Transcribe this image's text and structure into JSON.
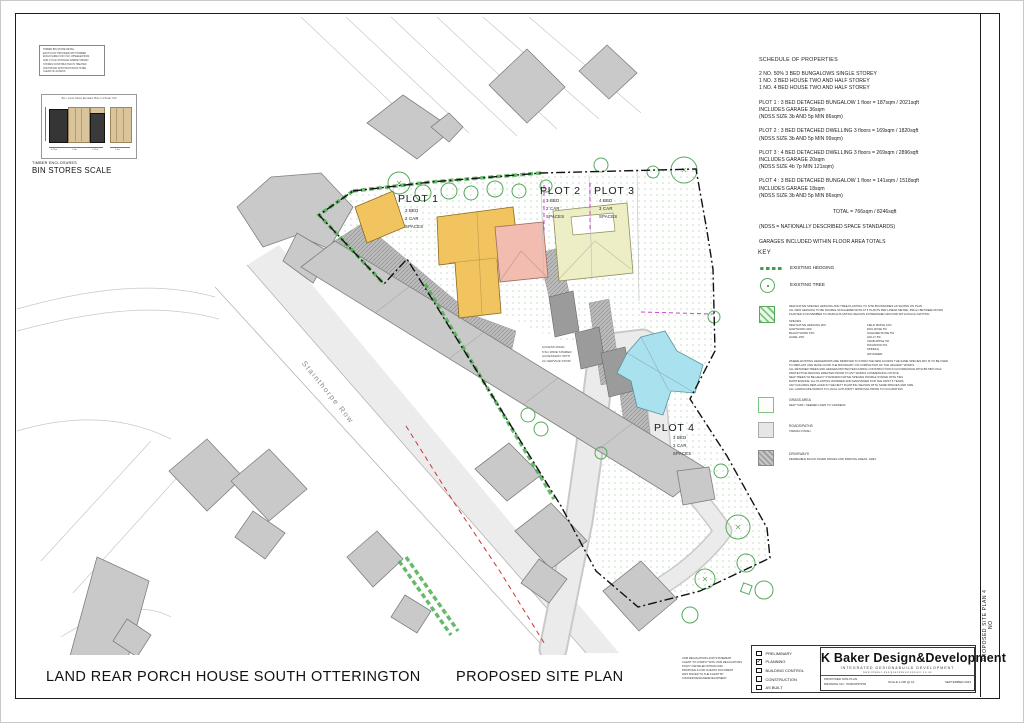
{
  "page": {
    "project_title": "LAND REAR PORCH HOUSE SOUTH OTTERINGTON",
    "drawing_title": "PROPOSED SITE PLAN",
    "side_label": "PROPOSED SITE PLAN 4 NO"
  },
  "bin_store": {
    "note_lines": [
      "TIMBER BIN STORE DETAIL",
      "EACH PLOT PROVIDED WITH TIMBER",
      "ENCLOSURE FOR 3 NO. WHEELED BINS",
      "AND CYCLE STORAGE WHERE SHOWN",
      "STORES CONSTRUCTED IN TREATED",
      "SOFTWOOD WITH PENT ROOF SITED",
      "CLEAR OF ACCESS"
    ],
    "panel_title": "Bin + Cycle Stores Elevation  Plots 1-4  Scale 1:50",
    "dims": [
      "0.75m",
      "1.5m",
      "0.75m",
      "1.5m"
    ],
    "caption_small": "TIMBER ENCLOSURES",
    "caption": "BIN STORES SCALE"
  },
  "schedule": {
    "heading": "SCHEDULE OF PROPERTIES",
    "summary_lines": [
      "2 NO. 50% 3 BED BUNGALOWS SINGLE STOREY",
      "1 NO. 3 BED HOUSE TWO AND HALF STOREY",
      "1 NO. 4 BED HOUSE TWO AND HALF STOREY"
    ],
    "plots": [
      {
        "line1": "PLOT 1 : 3 BED DETACHED BUNGALOW 1 floor  = 187sqm / 2021sqft",
        "line2": "INCLUDES GARAGE 36sqm",
        "line3": "(NDSS SIZE 3b AND 5p MIN 86sqm)"
      },
      {
        "line1": "PLOT 2 : 3 BED DETACHED DWELLING  3 floors = 169sqm / 1820sqft",
        "line2": "",
        "line3": "(NDSS SIZE 3b AND 5p MIN 99sqm)"
      },
      {
        "line1": "PLOT 3 : 4 BED DETACHED DWELLING 3 floors  = 269sqm / 2896sqft",
        "line2": "INCLUDES GARAGE 20sqm",
        "line3": "(NDSS SIZE 4b 7p MIN 121sqm)"
      },
      {
        "line1": "PLOT 4 : 3 BED DETACHED BUNGALOW 1 floor  = 141sqm / 1518sqft",
        "line2": "INCLUDES GARAGE 18sqm",
        "line3": "(NDSS SIZE 3b AND 5p MIN 86sqm)"
      }
    ],
    "total": "TOTAL = 766sqm / 8246sqft",
    "ndss_note": "(NDSS = NATIONALLY DESCRIBED SPACE STANDARDS)",
    "garages_note": "GARAGES INCLUDED WITHIN FLOOR AREA TOTALS"
  },
  "key": {
    "heading": "KEY",
    "hedging_label": "EXISTING HEDGING",
    "tree_label": "EXISTING TREE",
    "planting_intro_lines": [
      "NEW NATIVE SPECIES HEDGING AND TREE PLANTING TO SITE BOUNDARIES AS SHOWN ON PLAN",
      "ALL NEW HEDGING TO BE DOUBLE STAGGERED ROW AT 5 PLANTS PER LINEAR METRE, 450mm BETWEEN ROWS",
      "PLANTED IN NOVEMBER TO MARCH PLANTING SEASON IN PREPARED GROUND WITH MULCH MATTING"
    ],
    "species_heading": "SPECIES",
    "species_col1": [
      "NEW NATIVE HEDGING MIX:",
      "HAWTHORN 40%",
      "BLACKTHORN 15%",
      "HAZEL 15%"
    ],
    "species_col2": [
      "FIELD MAPLE 10%",
      "DOG ROSE 5%",
      "GUELDER ROSE 5%",
      "HOLLY 5%",
      "CRAB APPLE 5%",
      "DOGWOOD 5%",
      "SPINDLE",
      "WAYFARER"
    ],
    "planting_notes_lines": [
      "WHERE EXISTING HEDGEROWS ARE REMOVED TO FORM THE NEW ACCESS THE SAME SPECIES MIX IS TO BE USED",
      "TO REPLANT AND MAKE GOOD THE BOUNDARY ON COMPLETION OF THE HIGHWAY WORKS",
      "ALL RETAINED TREES AND HEDGES PROTECTED DURING CONSTRUCTION IN ACCORDANCE WITH BS 5837:2012",
      "PROTECTIVE FENCING ERECTED PRIOR TO ANY WORKS COMMENCING ON SITE",
      "NEW TREES TO BE HEAVY STANDARD NATIVE SPECIES DOUBLE STAKED WITH TIES",
      "MAINTENANCE: ALL PLANTING WATERED AND MAINTAINED FOR THE FIRST 5 YEARS",
      "ANY FAILURES REPLACED IN THE NEXT PLANTING SEASON WITH SAME SPECIES AND SIZE",
      "ALL LANDSCAPE WORKS TO LOCAL AUTHORITY APPROVAL PRIOR TO OCCUPATION"
    ],
    "grass_label": "GRASS AREA",
    "grass_sub": "NEW TURF / SEEDED LAWN TO GARDENS",
    "roads_label": "ROADS/PATHS",
    "roads_sub": "TARMAC FINISH",
    "driveways_label": "DRIVEWAYS",
    "driveways_sub": "PERMEABLE BLOCK PAVED DRIVES AND PARKING AREAS, GREY"
  },
  "map": {
    "road_label": "Stainthorpe Row",
    "access_note_lines": [
      "ACCESS ROAD",
      "5.5m WIDE SHARED",
      "ACCESSWAY WITH",
      "2m SERVICE STRIP"
    ],
    "plots": [
      {
        "label": "PLOT 1",
        "lines": [
          "3 BED",
          "2 CAR",
          "SPACES"
        ],
        "color": "#f2c45f"
      },
      {
        "label": "PLOT 2",
        "lines": [
          "3 BED",
          "2 CAR",
          "SPACES"
        ],
        "color": "#f2bdb0"
      },
      {
        "label": "PLOT 3",
        "lines": [
          "4 BED",
          "3 CAR",
          "SPACES"
        ],
        "color": "#eeeec6"
      },
      {
        "label": "PLOT 4",
        "lines": [
          "3 BED",
          "2 CAR",
          "SPACES"
        ],
        "color": "#a9e2ee"
      }
    ],
    "colors": {
      "hedge_green": "#4cae4f",
      "tree_green": "#55a95c",
      "boundary": "#111111",
      "existing_building": "#c9c9c9",
      "red_line": "#cc3333",
      "magenta_line": "#cc44cc"
    }
  },
  "title_block": {
    "cdm_lines": [
      "CDM REGULATIONS 2015 STATEMENT",
      "CLIENT TO COMPLY WITH CDM REGULATIONS",
      "POLICY DETAILED WITHIN CDM",
      "PROPOSALS FOR CLIENTS DOCUMENT",
      "2015 ISSUED TO THE CLIENT BY",
      "K BAKER DESIGN&DEVELOPMENT"
    ],
    "status_options": [
      {
        "label": "PRELIMINARY",
        "mark": ""
      },
      {
        "label": "PLANNING",
        "mark": "✓"
      },
      {
        "label": "BUILDING CONTROL",
        "mark": ""
      },
      {
        "label": "CONSTRUCTION",
        "mark": ""
      },
      {
        "label": "AS BUILT",
        "mark": ""
      }
    ],
    "company": "K Baker Design&Development",
    "tagline": "INTEGRATED DESIGN&BUILD DEVELOPMENT",
    "web": "www.kbaker-designanddevelopment.co.uk",
    "info_line1": "PROPOSED SITE PLAN",
    "info_line2": "DRAWING NO : PMR/OPP/P02",
    "scale": "SCALE 1:200 @ A1",
    "date": "SEPTEMBER 2023"
  }
}
